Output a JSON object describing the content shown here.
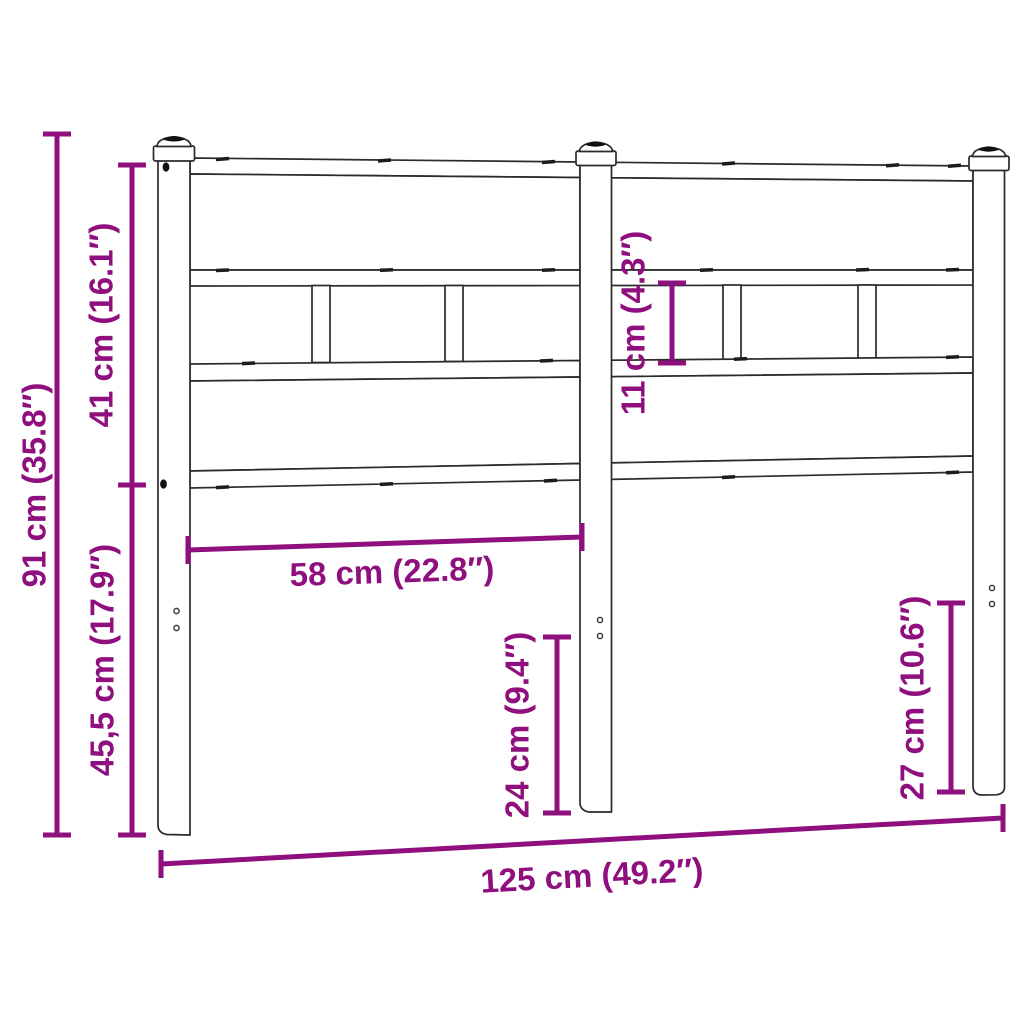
{
  "diagram": {
    "kind": "product-dimension-diagram",
    "subject": "metal-and-wood headboard, front view",
    "background": "#ffffff"
  },
  "colors": {
    "dimension_annotation": "#8E0F7D",
    "line_art": "#2b2b2b",
    "background": "#ffffff"
  },
  "dims": {
    "total_height": {
      "label": "91 cm (35.8″)",
      "value_cm": "91",
      "value_inch": "35.8"
    },
    "panel_height": {
      "label": "41 cm (16.1″)",
      "value_cm": "41",
      "value_inch": "16.1"
    },
    "leg_height": {
      "label": "45,5 cm (17.9″)",
      "value_cm": "45,5",
      "value_inch": "17.9"
    },
    "slat_gap_height": {
      "label": "11 cm (4.3″)",
      "value_cm": "11",
      "value_inch": "4.3"
    },
    "panel_width": {
      "label": "58 cm (22.8″)",
      "value_cm": "58",
      "value_inch": "22.8"
    },
    "mid_leg_clearance": {
      "label": "24 cm (9.4″)",
      "value_cm": "24",
      "value_inch": "9.4"
    },
    "side_leg_clearance": {
      "label": "27 cm (10.6″)",
      "value_cm": "27",
      "value_inch": "10.6"
    },
    "total_width": {
      "label": "125 cm (49.2″)",
      "value_cm": "125",
      "value_inch": "49.2"
    }
  }
}
